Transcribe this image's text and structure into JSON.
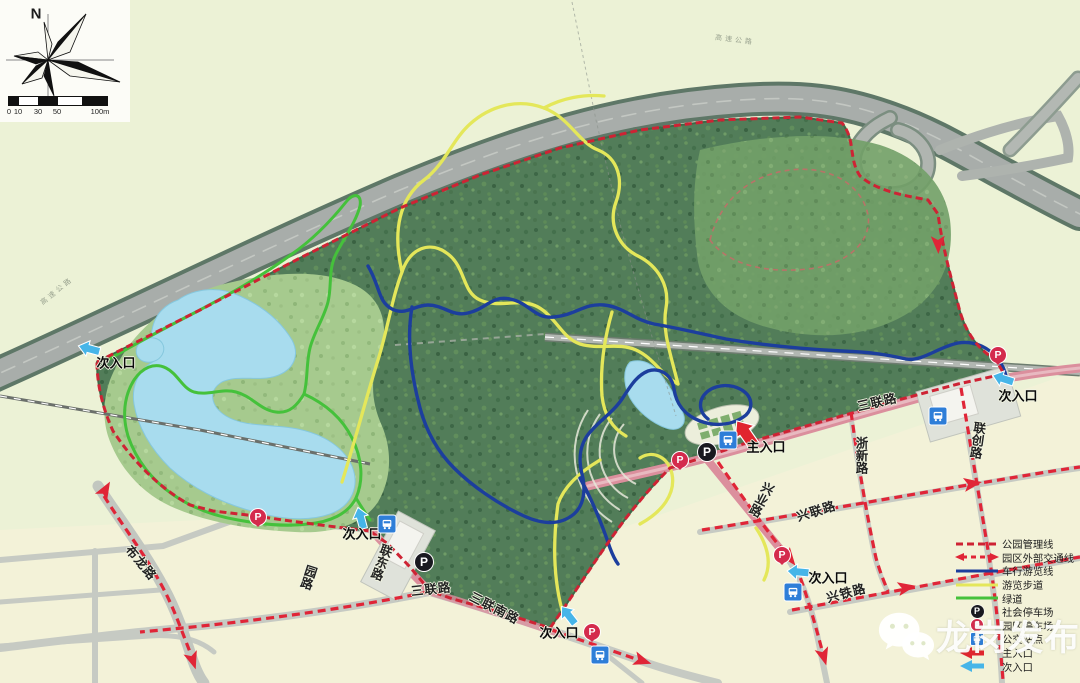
{
  "compass": {
    "north_label": "N"
  },
  "scale_bar": {
    "ticks": [
      "0",
      "10",
      "30",
      "50",
      "100m"
    ]
  },
  "highway": {
    "label": "高速公路"
  },
  "roads": {
    "bulong": "布龙路",
    "yuan": "园路",
    "liandong": "联东路",
    "sanlian_west": "三联路",
    "sanlian_south": "三联南路",
    "sanlian_east": "三联路",
    "xingye": "兴业路",
    "xinglian": "兴联路",
    "xingtie": "兴铁路",
    "zhexin": "浙新路",
    "lianchuang": "联创路"
  },
  "entrances": {
    "main": "主入口",
    "secondary": "次入口"
  },
  "icons": {
    "parking_glyph": "P"
  },
  "legend": {
    "items": [
      {
        "id": "park-admin-line",
        "label": "公园管理线",
        "type": "line-dashed",
        "color": "#ce2334"
      },
      {
        "id": "external-traffic-line",
        "label": "园区外部交通线",
        "type": "line-dashed-arrows",
        "color": "#e02537"
      },
      {
        "id": "vehicle-tour-line",
        "label": "车行游览线",
        "type": "line",
        "color": "#1c3e9d"
      },
      {
        "id": "walking-trail",
        "label": "游览步道",
        "type": "line",
        "color": "#e4e75a"
      },
      {
        "id": "greenway",
        "label": "绿道",
        "type": "line",
        "color": "#45c13b"
      },
      {
        "id": "public-parking",
        "label": "社会停车场",
        "type": "icon-p-black"
      },
      {
        "id": "park-parking",
        "label": "园区停车场",
        "type": "icon-p-red"
      },
      {
        "id": "bus-stop",
        "label": "公交站点",
        "type": "icon-bus"
      },
      {
        "id": "main-entrance",
        "label": "主入口",
        "type": "arrow-red"
      },
      {
        "id": "secondary-entrance",
        "label": "次入口",
        "type": "arrow-blue"
      }
    ]
  },
  "watermark": {
    "text": "龙岗发布"
  }
}
